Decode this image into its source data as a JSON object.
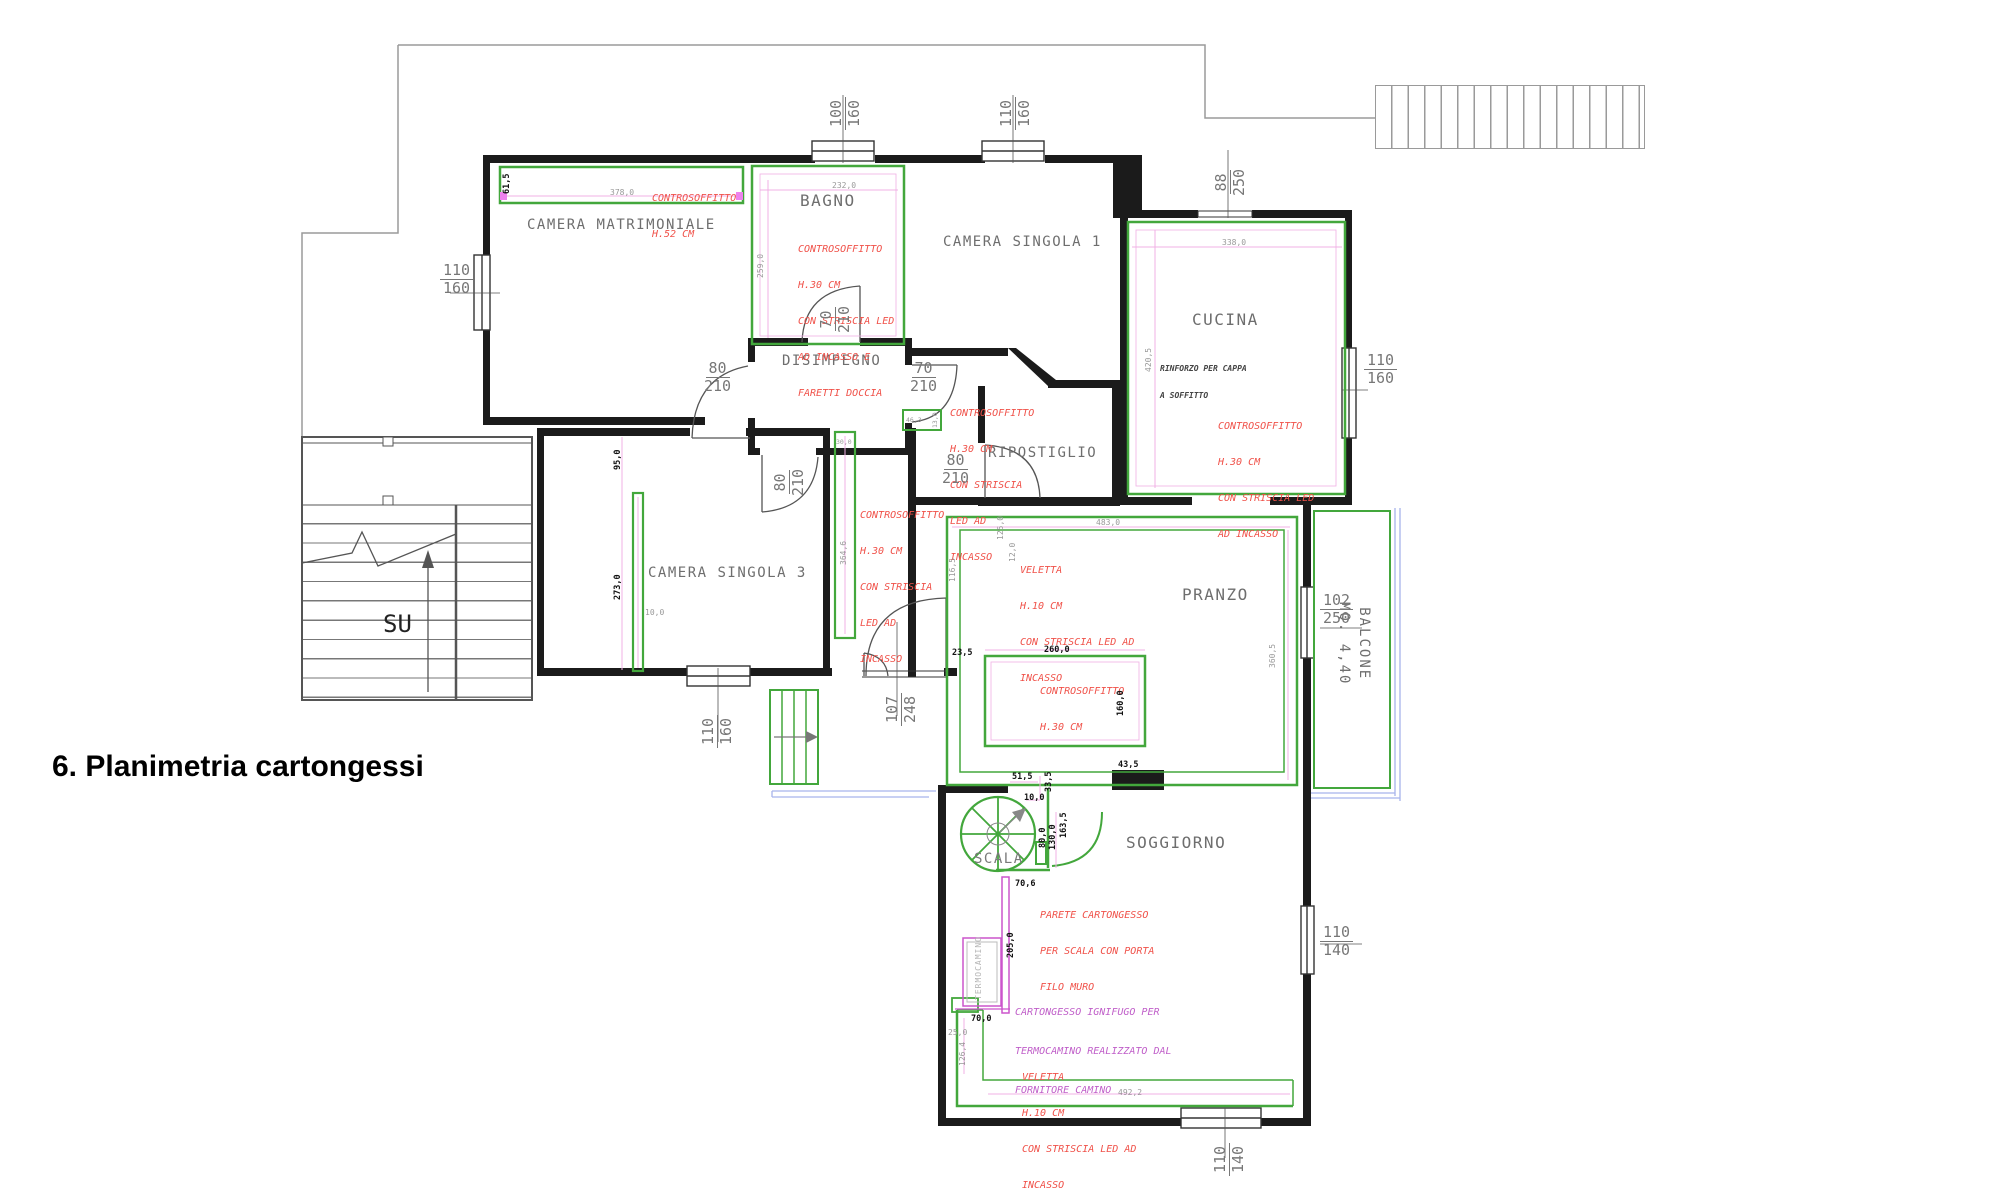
{
  "title": "6. Planimetria cartongessi",
  "colors": {
    "wall": "#1b1b1b",
    "cartongesso_green": "#43a73c",
    "annotation_red": "#f0524a",
    "annotation_magenta": "#c05fc9",
    "dimension_pink": "#f0b0e4",
    "balcony_blue": "#a8b4ec",
    "label_gray": "#6e6e6e"
  },
  "rooms": {
    "camera_matrimoniale": "CAMERA MATRIMONIALE",
    "bagno": "BAGNO",
    "camera_singola_1": "CAMERA SINGOLA 1",
    "cucina": "CUCINA",
    "disimpegno": "DISIMPEGNO",
    "ripostiglio": "RIPOSTIGLIO",
    "camera_singola_3": "CAMERA SINGOLA 3",
    "pranzo": "PRANZO",
    "soggiorno": "SOGGIORNO",
    "scala": "SCALA",
    "balcone_line1": "BALCONE",
    "balcone_line2": "MQ. 4,40",
    "termocamino": "TERMOCAMINO",
    "su": "SU"
  },
  "annotations": {
    "cm": [
      "CONTROSOFFITTO",
      "H.52 CM"
    ],
    "bagno": [
      "CONTROSOFFITTO",
      "H.30 CM",
      "CON STRISCIA LED",
      "AD INCASSO E",
      "FARETTI DOCCIA"
    ],
    "cucina": [
      "CONTROSOFFITTO",
      "H.30 CM",
      "CON STRISCIA LED",
      "AD INCASSO"
    ],
    "vestibolo": [
      "CONTROSOFFITTO",
      "H.30 CM",
      "CON STRISCIA",
      "LED AD",
      "INCASSO"
    ],
    "corridoio": [
      "CONTROSOFFITTO",
      "H.30 CM",
      "CON STRISCIA",
      "LED AD",
      "INCASSO"
    ],
    "pranzo_veletta": [
      "VELETTA",
      "H.10 CM",
      "CON STRISCIA LED AD",
      "INCASSO"
    ],
    "pranzo_controsoffitto": [
      "CONTROSOFFITTO",
      "H.30 CM"
    ],
    "scala_parete": [
      "PARETE CARTONGESSO",
      "PER SCALA CON PORTA",
      "FILO MURO"
    ],
    "termocamino_nota": [
      "CARTONGESSO IGNIFUGO PER",
      "TERMOCAMINO REALIZZATO DAL",
      "FORNITORE CAMINO"
    ],
    "sogg_veletta": [
      "VELETTA",
      "H.10 CM",
      "CON STRISCIA LED AD",
      "INCASSO"
    ],
    "cappa": [
      "RINFORZO PER CAPPA",
      "A SOFFITTO"
    ]
  },
  "fractions": {
    "cm_window": {
      "top": "110",
      "bottom": "160"
    },
    "bagno_window": {
      "top": "100",
      "bottom": "160"
    },
    "cs1_window": {
      "top": "110",
      "bottom": "160"
    },
    "cucina_door": {
      "top": "88",
      "bottom": "250"
    },
    "cucina_window": {
      "top": "110",
      "bottom": "160"
    },
    "disimpegno_left_door": {
      "top": "80",
      "bottom": "210"
    },
    "bagno_door": {
      "top": "70",
      "bottom": "210"
    },
    "disimpegno_right_door": {
      "top": "70",
      "bottom": "210"
    },
    "disimpegno_bottom_door": {
      "top": "80",
      "bottom": "210"
    },
    "ripostiglio_door": {
      "top": "80",
      "bottom": "210"
    },
    "cs3_window": {
      "top": "110",
      "bottom": "160"
    },
    "entrance_door": {
      "top": "107",
      "bottom": "248"
    },
    "balcone_door": {
      "top": "102",
      "bottom": "250"
    },
    "sogg_right_window": {
      "top": "110",
      "bottom": "140"
    },
    "sogg_bottom_window": {
      "top": "110",
      "bottom": "140"
    }
  },
  "measures": {
    "cm_h": "61,5",
    "cm_w": "378,0",
    "bagno_w": "232,0",
    "bagno_h": "259,0",
    "cucina_w": "338,0",
    "cucina_h": "420,5",
    "cs3_a": "95,0",
    "cs3_b": "273,0",
    "cs3_t": "10,0",
    "corr_w": "30,0",
    "corr_l": "364,6",
    "vest_a": "46,3",
    "vest_b": "13,0",
    "pranzo_w": "483,0",
    "pranzo_a": "125,0",
    "pranzo_b": "12,0",
    "pranzo_c": "116,5",
    "pranzo_d": "360,5",
    "inner_w": "260,0",
    "inner_a": "23,5",
    "inner_h": "160,0",
    "inner_b": "43,5",
    "scala_a": "51,5",
    "scala_b": "33,5",
    "scala_c": "10,0",
    "scala_d": "80,0",
    "scala_e": "130,0",
    "scala_f": "163,5",
    "scala_g": "70,6",
    "scala_h": "205,0",
    "sogg_a": "70,0",
    "sogg_b": "25,0",
    "sogg_c": "126,4",
    "sogg_d": "492,2"
  }
}
